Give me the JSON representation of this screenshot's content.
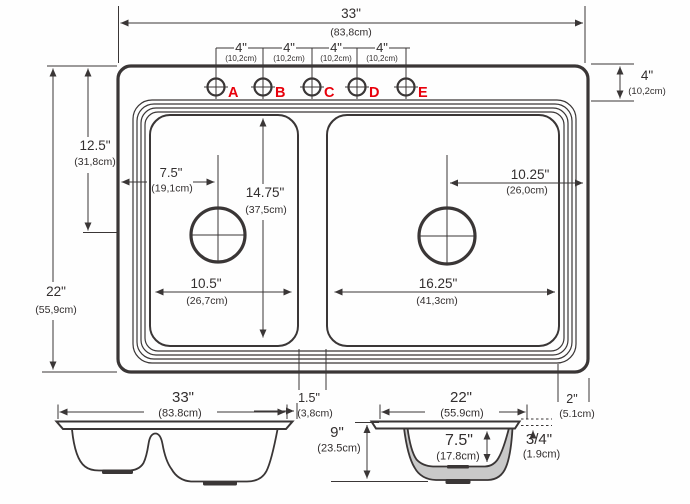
{
  "top_view": {
    "holes": [
      "A",
      "B",
      "C",
      "D",
      "E"
    ],
    "width_33": {
      "imperial": "33\"",
      "metric": "(83,8cm)"
    },
    "spacing_4": {
      "imperial": "4\"",
      "metric": "(10,2cm)"
    },
    "offset_4_right": {
      "imperial": "4\"",
      "metric": "(10,2cm)"
    },
    "depth_22": {
      "imperial": "22\"",
      "metric": "(55,9cm)"
    },
    "drain_125": {
      "imperial": "12.5\"",
      "metric": "(31,8cm)"
    },
    "drain_75": {
      "imperial": "7.5\"",
      "metric": "(19,1cm)"
    },
    "bowl_1475": {
      "imperial": "14.75\"",
      "metric": "(37,5cm)"
    },
    "bowl_105": {
      "imperial": "10.5\"",
      "metric": "(26,7cm)"
    },
    "drain_1025": {
      "imperial": "10.25\"",
      "metric": "(26,0cm)"
    },
    "bowl_1625": {
      "imperial": "16.25\"",
      "metric": "(41,3cm)"
    },
    "divider_15": {
      "imperial": "1.5\"",
      "metric": "(3,8cm)"
    },
    "edge_2": {
      "imperial": "2\"",
      "metric": "(5.1cm)"
    }
  },
  "side_view": {
    "width_33": {
      "imperial": "33\"",
      "metric": "(83.8cm)"
    }
  },
  "section_view": {
    "width_22": {
      "imperial": "22\"",
      "metric": "(55.9cm)"
    },
    "height_9": {
      "imperial": "9\"",
      "metric": "(23.5cm)"
    },
    "bowl_depth_75": {
      "imperial": "7.5\"",
      "metric": "(17.8cm)"
    },
    "rim_34": {
      "imperial": "3/4\"",
      "metric": "(1.9cm)"
    }
  },
  "colors": {
    "line": "#3a3636",
    "text": "#322e2e",
    "accent_red": "#e8000b",
    "bowl_fill": "#c9c9c9",
    "background": "#fefefe"
  }
}
